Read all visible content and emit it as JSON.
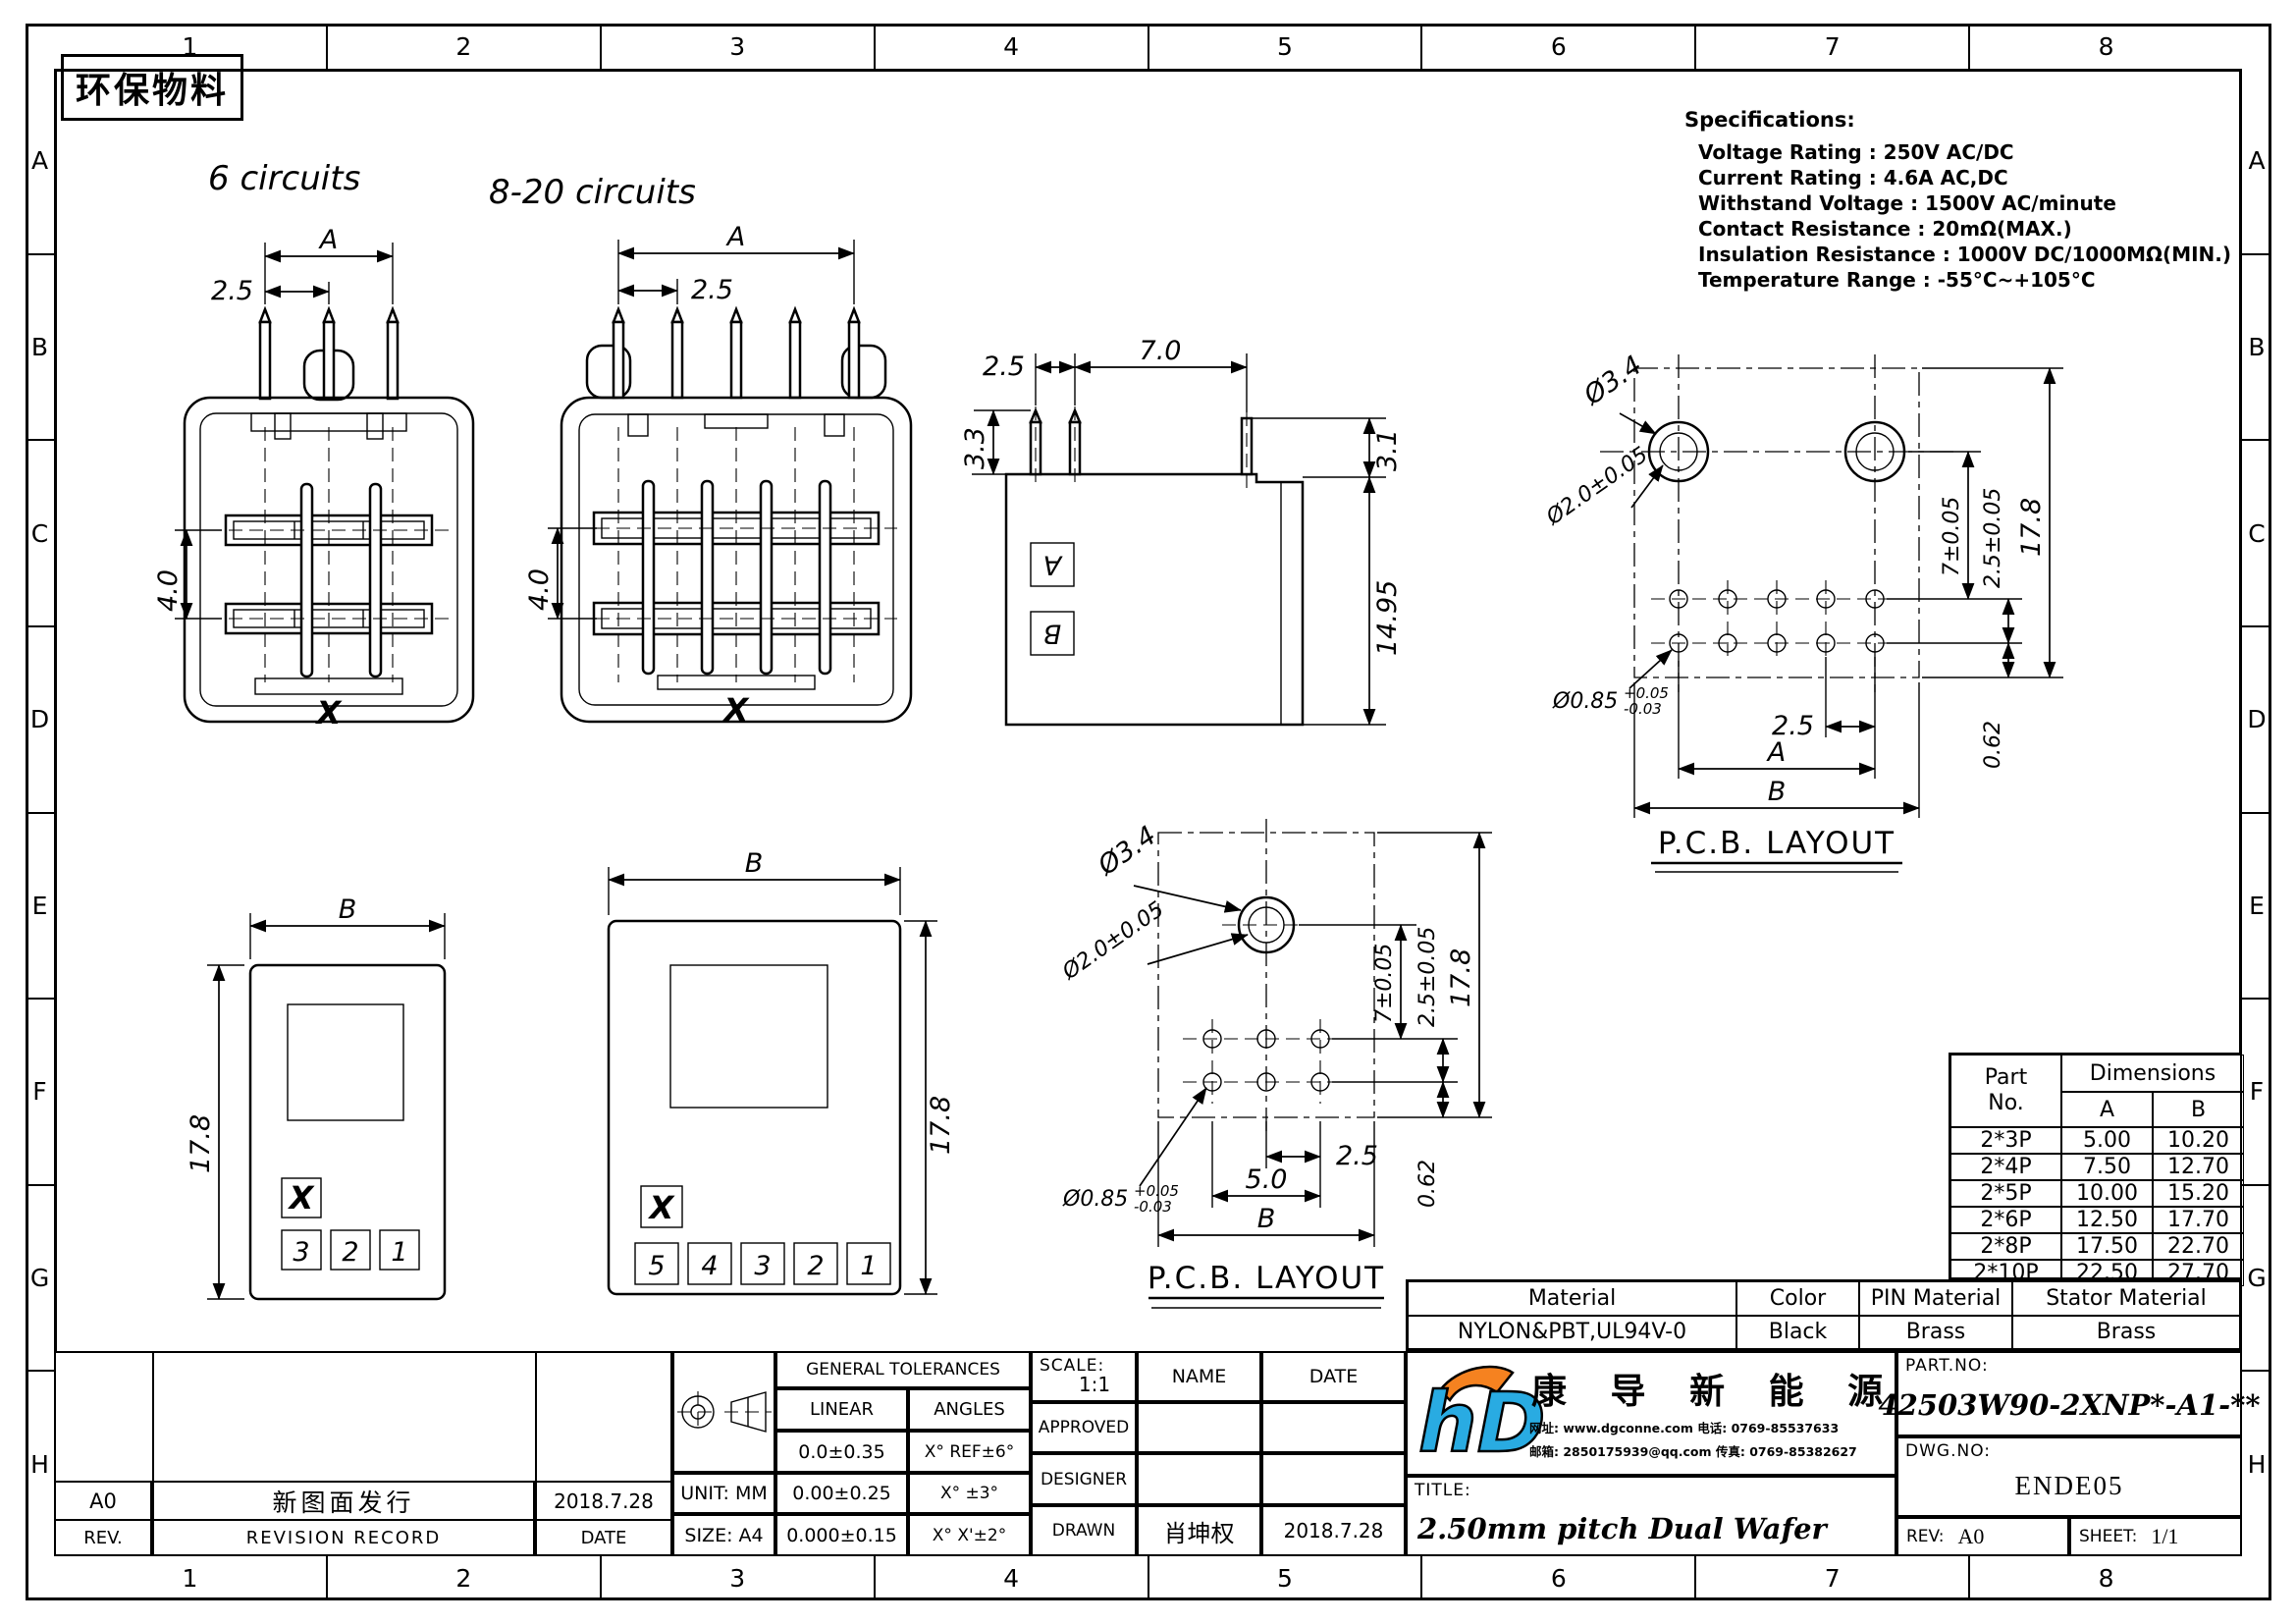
{
  "sheet": {
    "eco_label": "环保物料",
    "cols": [
      "1",
      "2",
      "3",
      "4",
      "5",
      "6",
      "7",
      "8"
    ],
    "rows": [
      "A",
      "B",
      "C",
      "D",
      "E",
      "F",
      "G",
      "H"
    ]
  },
  "specs": {
    "title": "Specifications:",
    "lines": [
      "Voltage Rating : 250V AC/DC",
      "Current Rating : 4.6A AC,DC",
      "Withstand Voltage : 1500V AC/minute",
      "Contact Resistance : 20mΩ(MAX.)",
      "Insulation Resistance : 1000V DC/1000MΩ(MIN.)",
      "Temperature Range : -55°C~+105°C"
    ]
  },
  "views": {
    "front6": {
      "label": "6 circuits",
      "dim_a": "A",
      "dim_pitch": "2.5",
      "dim_row": "4.0",
      "mark": "X"
    },
    "front8": {
      "label": "8-20 circuits",
      "dim_a": "A",
      "dim_pitch": "2.5",
      "dim_row": "4.0",
      "mark": "X"
    },
    "side": {
      "dim_pitch": "2.5",
      "dim_span": "7.0",
      "dim_pin": "3.3",
      "dim_step": "3.1",
      "dim_height": "14.95",
      "mark_a": "A",
      "mark_b": "B"
    },
    "bottom6": {
      "dim_b": "B",
      "dim_h": "17.8",
      "mark": "X",
      "pads": [
        "3",
        "2",
        "1"
      ]
    },
    "bottom8": {
      "dim_b": "B",
      "dim_h": "17.8",
      "mark": "X",
      "pads": [
        "5",
        "4",
        "3",
        "2",
        "1"
      ]
    },
    "pcb6": {
      "title": "P.C.B. LAYOUT",
      "dia_outer": "Ø3.4",
      "dia_inner": "Ø2.0±0.05",
      "dia_pin": "Ø0.85",
      "tol_up": "+0.05",
      "tol_dn": "-0.03",
      "dim7": "7±0.05",
      "dim25t": "2.5±0.05",
      "dim178": "17.8",
      "dim062": "0.62",
      "dim25": "2.5",
      "dim50": "5.0",
      "dimB": "B"
    },
    "pcb8": {
      "title": "P.C.B. LAYOUT",
      "dia_outer": "Ø3.4",
      "dia_inner": "Ø2.0±0.05",
      "dia_pin": "Ø0.85",
      "tol_up": "+0.05",
      "tol_dn": "-0.03",
      "dim7": "7±0.05",
      "dim25t": "2.5±0.05",
      "dim178": "17.8",
      "dim062": "0.62",
      "dim25": "2.5",
      "dimA": "A",
      "dimB": "B"
    }
  },
  "part_table": {
    "h_part": "Part",
    "h_no": "No.",
    "h_dim": "Dimensions",
    "h_a": "A",
    "h_b": "B",
    "rows": [
      {
        "no": "2*3P",
        "a": "5.00",
        "b": "10.20"
      },
      {
        "no": "2*4P",
        "a": "7.50",
        "b": "12.70"
      },
      {
        "no": "2*5P",
        "a": "10.00",
        "b": "15.20"
      },
      {
        "no": "2*6P",
        "a": "12.50",
        "b": "17.70"
      },
      {
        "no": "2*8P",
        "a": "17.50",
        "b": "22.70"
      },
      {
        "no": "2*10P",
        "a": "22.50",
        "b": "27.70"
      }
    ]
  },
  "material_table": {
    "h_material": "Material",
    "h_color": "Color",
    "h_pin": "PIN Material",
    "h_stator": "Stator Material",
    "material": "NYLON&PBT,UL94V-0",
    "color": "Black",
    "pin": "Brass",
    "stator": "Brass"
  },
  "revision": {
    "rev": "A0",
    "record": "新图面发行",
    "date": "2018.7.28",
    "h_rev": "REV.",
    "h_record": "REVISION RECORD",
    "h_date": "DATE"
  },
  "tolerances": {
    "title": "GENERAL TOLERANCES",
    "h_linear": "LINEAR",
    "h_angles": "ANGLES",
    "rows": [
      [
        "0.0±0.35",
        "X° REF±6°"
      ],
      [
        "0.00±0.25",
        "X° ±3°"
      ],
      [
        "0.000±0.15",
        "X° X'±2°"
      ]
    ],
    "unit": "UNIT: MM",
    "size": "SIZE: A4"
  },
  "approval": {
    "scale_label": "SCALE:",
    "scale": "1:1",
    "h_name": "NAME",
    "h_date": "DATE",
    "approved": "APPROVED",
    "designer": "DESIGNER",
    "drawn": "DRAWN",
    "drawn_name": "肖坤权",
    "drawn_date": "2018.7.28"
  },
  "company": {
    "logo_text": "hD",
    "name": "康 导 新 能 源",
    "contact1": "网址: www.dgconne.com  电话: 0769-85537633",
    "contact2": "邮箱: 2850175939@qq.com 传真: 0769-85382627"
  },
  "titleblock": {
    "title_label": "TITLE:",
    "title": "2.50mm pitch Dual Wafer",
    "part_no_label": "PART.NO:",
    "part_no": "42503W90-2XNP*-A1-**",
    "dwg_no_label": "DWG.NO:",
    "dwg_no": "ENDE05",
    "rev_label": "REV:",
    "rev": "A0",
    "sheet_label": "SHEET:",
    "sheet": "1/1"
  },
  "colors": {
    "logo_blue": "#29abe2",
    "logo_orange": "#f58220"
  }
}
